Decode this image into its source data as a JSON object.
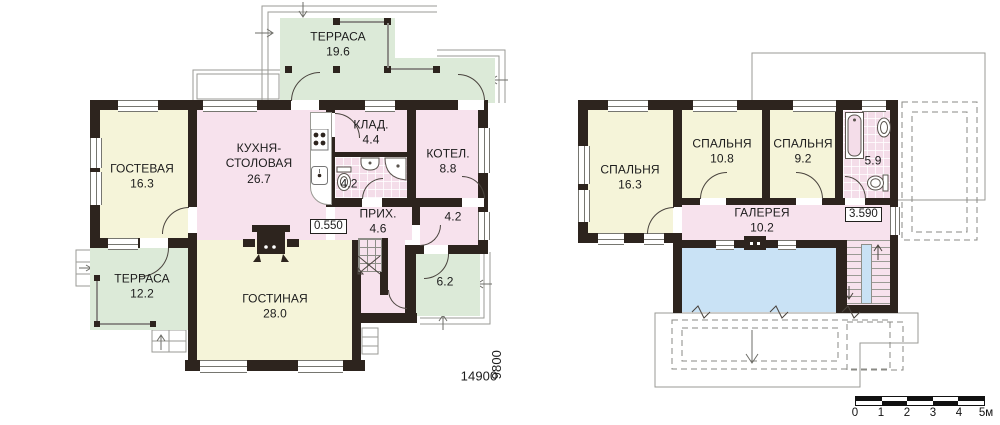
{
  "floor1": {
    "terrace_top": {
      "name": "ТЕРРАСА",
      "area": "19.6"
    },
    "guest": {
      "name": "ГОСТЕВАЯ",
      "area": "16.3"
    },
    "kitchen": {
      "line1": "КУХНЯ-",
      "line2": "СТОЛОВАЯ",
      "area": "26.7"
    },
    "storage": {
      "name": "КЛАД.",
      "area": "4.4"
    },
    "boiler": {
      "name": "КОТЕЛ.",
      "area": "8.8"
    },
    "bath": {
      "area": "4.2"
    },
    "hall": {
      "name": "ПРИХ.",
      "area": "4.6"
    },
    "vestibule": {
      "area": "4.2"
    },
    "living": {
      "name": "ГОСТИНАЯ",
      "area": "28.0"
    },
    "terrace_side": {
      "name": "ТЕРРАСА",
      "area": "12.2"
    },
    "porch": {
      "area": "6.2"
    },
    "elevation": "0.550",
    "dim_width": "14900",
    "dim_depth": "9800"
  },
  "floor2": {
    "bedroom1": {
      "name": "СПАЛЬНЯ",
      "area": "16.3"
    },
    "bedroom2": {
      "name": "СПАЛЬНЯ",
      "area": "10.8"
    },
    "bedroom3": {
      "name": "СПАЛЬНЯ",
      "area": "9.2"
    },
    "bath": {
      "area": "5.9"
    },
    "gallery": {
      "name": "ГАЛЕРЕЯ",
      "area": "10.2"
    },
    "elevation": "3.590"
  },
  "scale_bar": {
    "labels": [
      "0",
      "1",
      "2",
      "3",
      "4",
      "5м"
    ]
  },
  "colors": {
    "wall": "#2d241e",
    "room_yellow": "#f5f4d9",
    "room_pink": "#f7e2ed",
    "room_green": "#dcead8",
    "tile_pink": "#f4dde9",
    "void_blue": "#c9e2f5",
    "construction_line": "#9a9a94"
  }
}
